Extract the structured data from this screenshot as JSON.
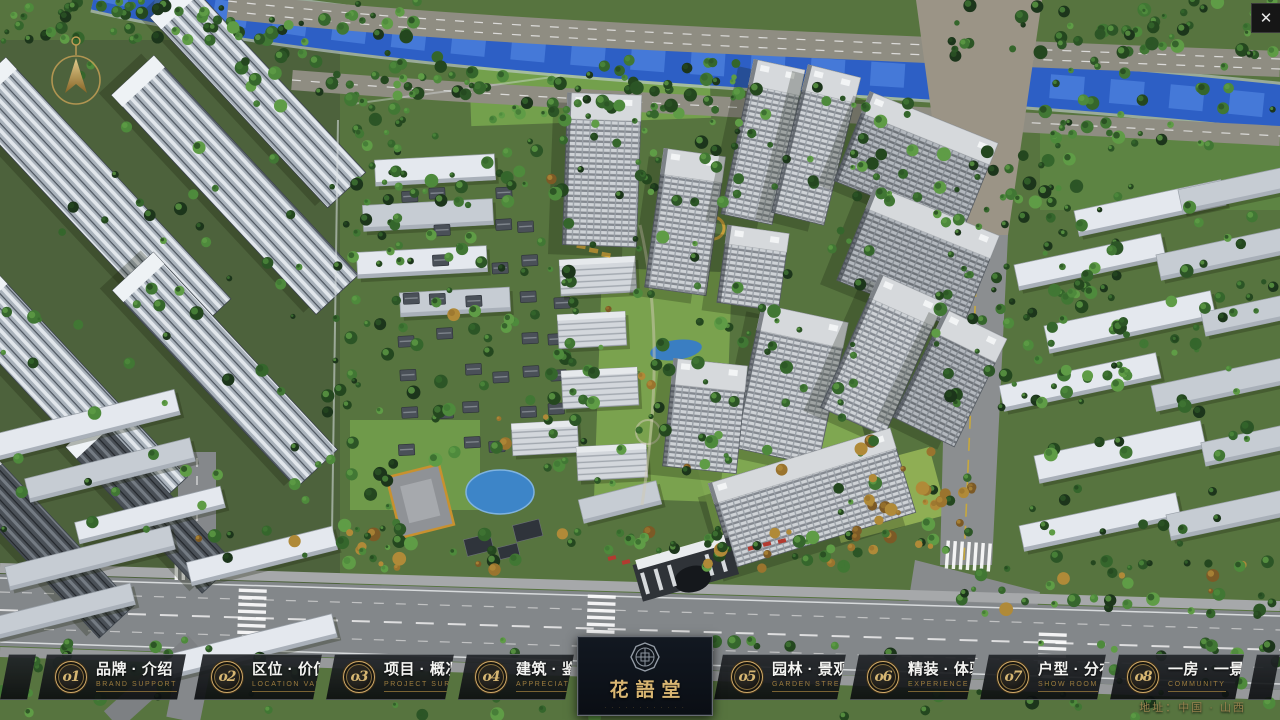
{
  "titlebar": {
    "close_icon": "✕"
  },
  "icons": {
    "close": "close-icon",
    "compass": "north-compass-arrow-icon",
    "emblem": "octagon-seal-icon"
  },
  "menu": {
    "items": [
      {
        "num": "o1",
        "label_cn": "品牌 · 介绍",
        "label_en": "BRAND SUPPORT"
      },
      {
        "num": "o2",
        "label_cn": "区位 · 价值",
        "label_en": "LOCATION VALUE"
      },
      {
        "num": "o3",
        "label_cn": "项目 · 概况",
        "label_en": "PROJECT SURVEY"
      },
      {
        "num": "o4",
        "label_cn": "建筑 · 鉴赏",
        "label_en": "APPRECIATION"
      },
      {
        "num": "o5",
        "label_cn": "园林 · 景观",
        "label_en": "GARDEN STREET"
      },
      {
        "num": "o6",
        "label_cn": "精装 · 体验",
        "label_en": "EXPERIENCE"
      },
      {
        "num": "o7",
        "label_cn": "户型 · 分布",
        "label_en": "SHOW ROOM"
      },
      {
        "num": "o8",
        "label_cn": "一房 · 一景",
        "label_en": "COMMUNITY"
      }
    ]
  },
  "logo": {
    "title": "花語堂",
    "subtitle": "· · · · · · · · · · · ·"
  },
  "footer": {
    "address": "地址：中国 · 山西"
  },
  "colors": {
    "gold": "#c9a766",
    "logo_gold": "#d9b672",
    "english_gold": "#9c7c3e",
    "river_blue": "#2d5fc5",
    "bar_bg": "rgba(16,18,21,0.88)"
  }
}
